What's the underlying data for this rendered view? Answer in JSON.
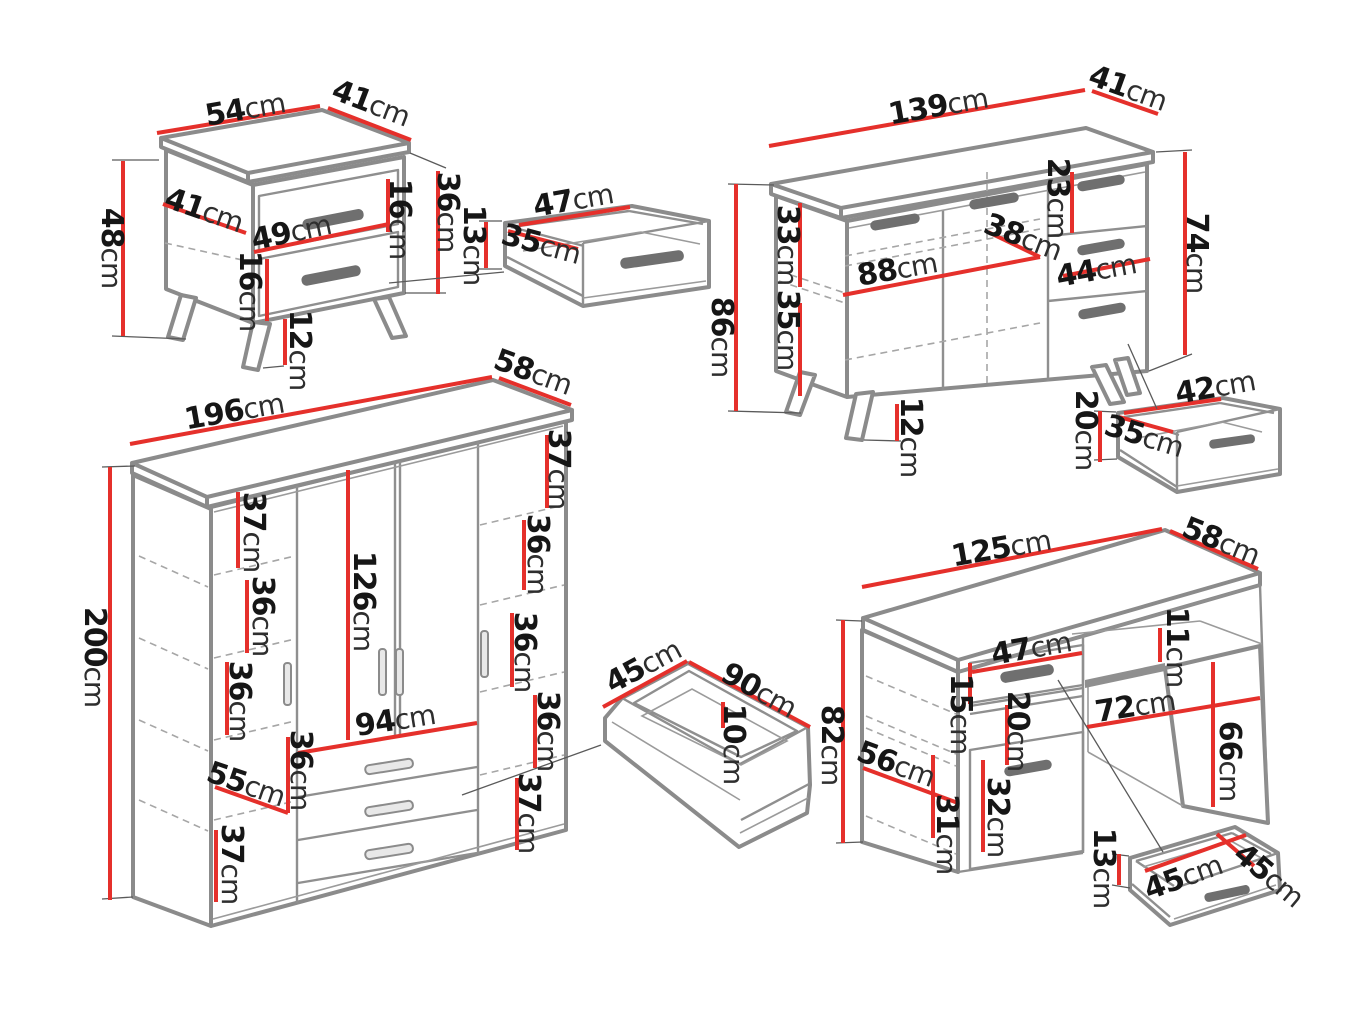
{
  "diagram": {
    "unit": "cm",
    "accent_color": "#e5302b",
    "outline_color": "#8b8b8b",
    "pieces": {
      "nightstand": {
        "width": "54cm",
        "depth": "41cm",
        "height": "48cm",
        "side_depth": "41cm",
        "drawer_width": "49cm",
        "top_drawer_height": "16cm",
        "carcass_height": "36cm",
        "bottom_drawer_height": "16cm",
        "leg_height": "12cm"
      },
      "nightstand_drawer": {
        "width": "47cm",
        "depth": "35cm",
        "height": "13cm"
      },
      "sideboard": {
        "width": "139cm",
        "depth": "41cm",
        "height": "86cm",
        "upper_section": "33cm",
        "lower_section": "35cm",
        "inner_width": "88cm",
        "inner_depth": "38cm",
        "top_drawer_height": "23cm",
        "drawer_width": "44cm",
        "carcass_height": "74cm",
        "leg_height": "12cm"
      },
      "sideboard_drawer": {
        "width": "42cm",
        "depth": "35cm",
        "height": "20cm"
      },
      "wardrobe": {
        "width": "196cm",
        "depth": "58cm",
        "height": "200cm",
        "left_section_1": "37cm",
        "left_section_2": "36cm",
        "left_section_3": "36cm",
        "hanging_height": "126cm",
        "drawer_width": "94cm",
        "drawer_section": "36cm",
        "bottom_shelf": "55cm",
        "bottom_left_section": "37cm",
        "right_section_1": "37cm",
        "right_section_2": "36cm",
        "right_section_3": "36cm",
        "right_section_4": "36cm",
        "right_section_5": "37cm"
      },
      "wardrobe_drawer": {
        "depth": "45cm",
        "width": "90cm",
        "height": "10cm"
      },
      "desk": {
        "width": "125cm",
        "depth": "58cm",
        "height": "82cm",
        "drawer_width": "47cm",
        "shelf_height": "11cm",
        "drawer_height": "15cm",
        "niche_height": "20cm",
        "door_height": "32cm",
        "side_depth": "56cm",
        "side_section": "31cm",
        "knee_width": "72cm",
        "knee_height": "66cm"
      },
      "desk_drawer": {
        "height": "13cm",
        "width": "45cm",
        "depth": "45cm"
      }
    }
  }
}
